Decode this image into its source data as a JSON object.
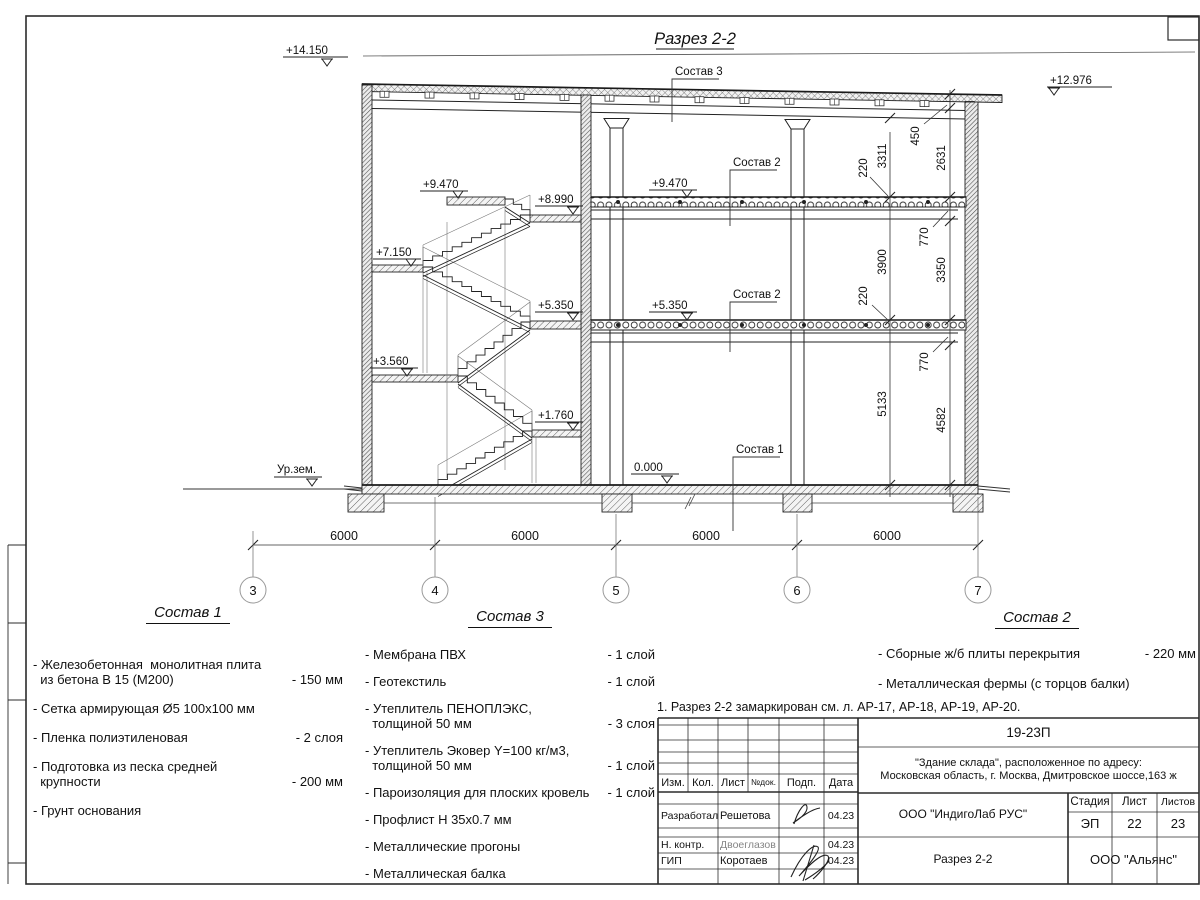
{
  "sheet": {
    "title": "Разрез 2-2",
    "note": "1. Разрез 2-2 замаркирован см. л. АР-17, АР-18, АР-19, АР-20."
  },
  "drawing": {
    "labels": {
      "sostav1": "Состав 1",
      "sostav2": "Состав 2",
      "sostav3": "Состав 3"
    },
    "elevations": {
      "top_left": "+14.150",
      "top_right": "+12.976",
      "l9470": "+9.470",
      "l8990": "+8.990",
      "l7150": "+7.150",
      "l5350": "+5.350",
      "l3560": "+3.560",
      "l1760": "+1.760",
      "zero": "0.000",
      "ground": "Ур.зем."
    },
    "dims_vertical_inner": [
      "3311",
      "3900",
      "5133"
    ],
    "dims_vertical_outer": [
      "450",
      "2631",
      "770",
      "3350",
      "770",
      "4582"
    ],
    "dims_thickness": [
      "220",
      "220"
    ],
    "dim_span": "6000",
    "axes": [
      "3",
      "4",
      "5",
      "6",
      "7"
    ]
  },
  "compositions": {
    "c1": {
      "title": "Состав 1",
      "items": [
        {
          "name": "- Железобетонная  монолитная плита\n  из бетона В 15 (М200)",
          "value": "- 150 мм"
        },
        {
          "name": "- Сетка армирующая Ø5 100x100 мм",
          "value": ""
        },
        {
          "name": "- Пленка полиэтиленовая",
          "value": "-  2 слоя"
        },
        {
          "name": "- Подготовка из песка средней\n  крупности",
          "value": "- 200 мм"
        },
        {
          "name": "- Грунт основания",
          "value": ""
        }
      ]
    },
    "c3": {
      "title": "Состав 3",
      "items": [
        {
          "name": "- Мембрана ПВХ",
          "value": "- 1 слой"
        },
        {
          "name": "- Геотекстиль",
          "value": "- 1 слой"
        },
        {
          "name": "- Утеплитель ПЕНОПЛЭКС,\n  толщиной 50 мм",
          "value": "- 3 слоя"
        },
        {
          "name": "- Утеплитель Эковер Y=100 кг/м3,\n  толщиной 50 мм",
          "value": "- 1 слой"
        },
        {
          "name": "- Пароизоляция для плоских кровель",
          "value": "- 1 слой"
        },
        {
          "name": "- Профлист Н 35х0.7 мм",
          "value": ""
        },
        {
          "name": "- Металлические прогоны",
          "value": ""
        },
        {
          "name": "- Металлическая балка",
          "value": ""
        }
      ]
    },
    "c2": {
      "title": "Состав 2",
      "items": [
        {
          "name": "- Сборные ж/б плиты перекрытия",
          "value": "- 220 мм"
        },
        {
          "name": "- Металлическая фермы (с торцов балки)",
          "value": ""
        }
      ]
    }
  },
  "titleblock": {
    "doc_number": "19-23П",
    "object_lines": "\"Здание склада\", расположенное по адресу:\nМосковская область, г. Москва, Дмитровское шоссе,163 ж",
    "org": "ООО \"ИндигоЛаб РУС\"",
    "stage_label": "Стадия",
    "sheet_label": "Лист",
    "sheets_label": "Листов",
    "stage": "ЭП",
    "sheet": "22",
    "sheets": "23",
    "drawing_name": "Разрез 2-2",
    "contractor": "ООО \"Альянс\"",
    "cols": {
      "izm": "Изм.",
      "kol": "Кол.",
      "list": "Лист",
      "doc": "№док.",
      "sign": "Подп.",
      "date": "Дата"
    },
    "rows": [
      {
        "role": "Разработал",
        "name": "Решетова",
        "date": "04.23"
      },
      {
        "role": "Н. контр.",
        "name": "Двоеглазов",
        "date": "04.23"
      },
      {
        "role": "ГИП",
        "name": "Коротаев",
        "date": "04.23"
      }
    ]
  }
}
